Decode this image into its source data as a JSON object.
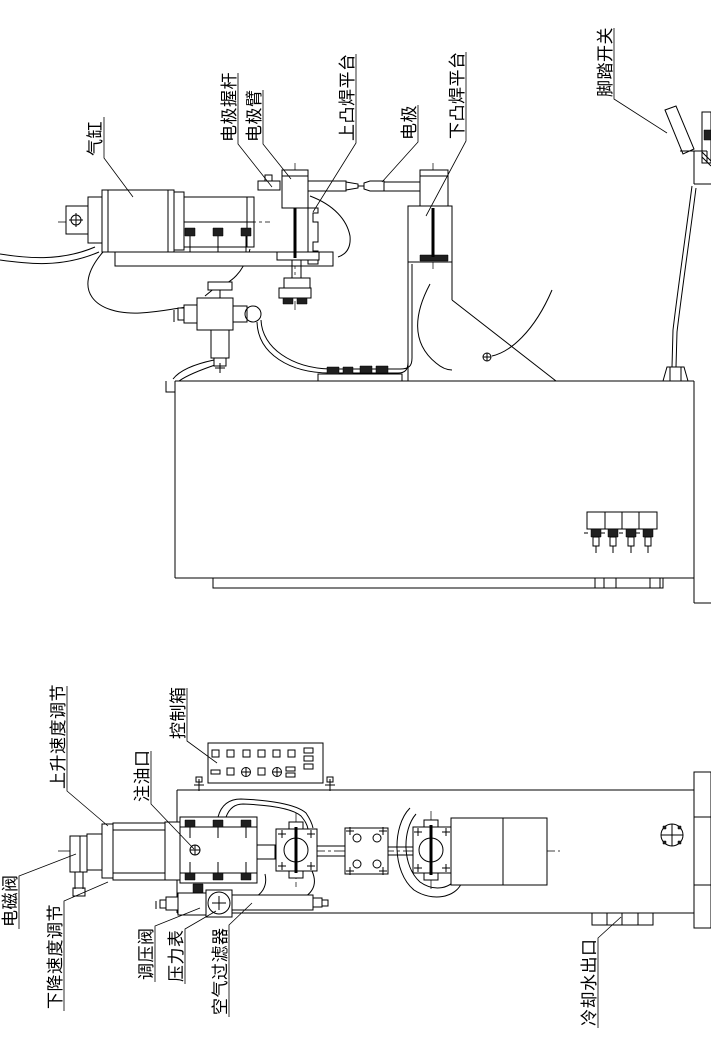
{
  "colors": {
    "line": "#000000",
    "background": "#ffffff"
  },
  "labels": {
    "top": [
      {
        "id": "air-cylinder",
        "text": "气缸"
      },
      {
        "id": "electrode-grip-rod",
        "text": "电极握杆"
      },
      {
        "id": "electrode-arm",
        "text": "电极臂"
      },
      {
        "id": "upper-projection-welding-platform",
        "text": "上凸焊平台"
      },
      {
        "id": "electrode",
        "text": "电极"
      },
      {
        "id": "lower-projection-welding-platform",
        "text": "下凸焊平台"
      },
      {
        "id": "foot-pedal-switch",
        "text": "脚踏开关"
      }
    ],
    "bottom": [
      {
        "id": "rise-speed-adjust",
        "text": "上升速度调节"
      },
      {
        "id": "control-box",
        "text": "控制箱"
      },
      {
        "id": "oil-filler-port",
        "text": "注油口"
      },
      {
        "id": "solenoid-valve",
        "text": "电磁阀"
      },
      {
        "id": "descent-speed-adjust",
        "text": "下降速度调节"
      },
      {
        "id": "pressure-regulating-valve",
        "text": "调压阀"
      },
      {
        "id": "pressure-gauge",
        "text": "压力表"
      },
      {
        "id": "air-filter",
        "text": "空气过滤器"
      },
      {
        "id": "cooling-water-outlet",
        "text": "冷却水出口"
      }
    ]
  }
}
